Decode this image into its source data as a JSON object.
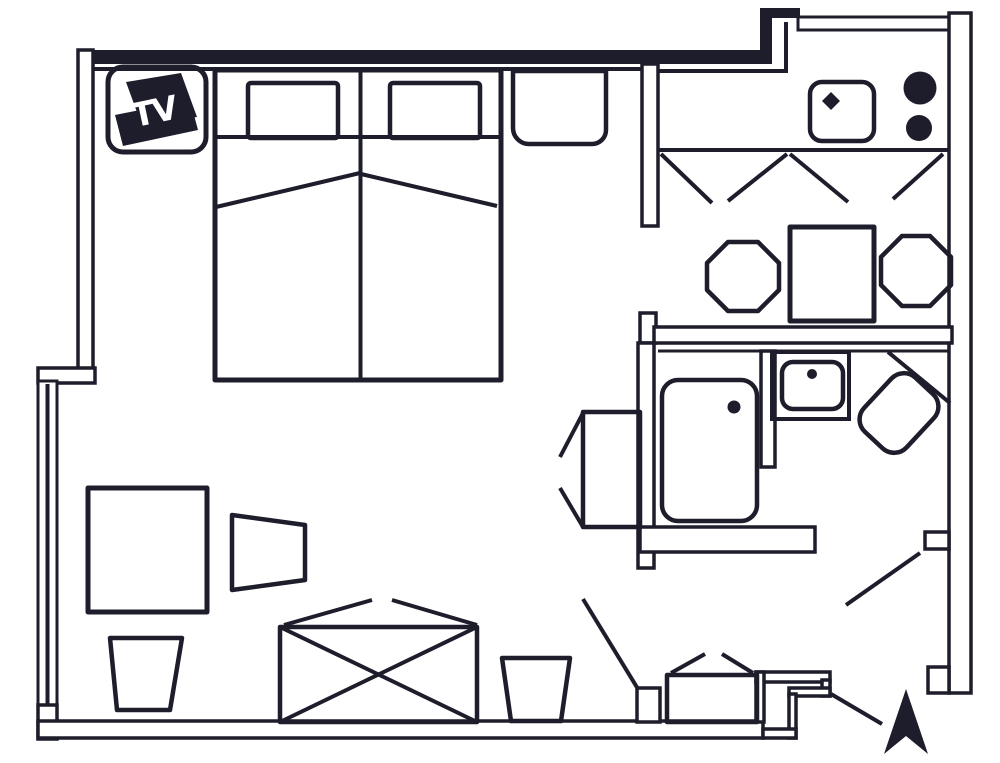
{
  "tv": {
    "label": "TV"
  },
  "colors": {
    "ink": "#1d1d2b",
    "background": "#ffffff"
  },
  "plan": {
    "type": "floor-plan",
    "rooms": [
      {
        "name": "bedroom-living-area",
        "symbols": [
          "double-bed",
          "pillow",
          "pillow",
          "tv-icon",
          "bedside-bench",
          "desk",
          "desk-chair",
          "wastebasket",
          "wastebasket",
          "luggage-rack",
          "wall-seat",
          "window"
        ]
      },
      {
        "name": "kitchenette-dining",
        "symbols": [
          "kitchen-sink",
          "hob-burner",
          "hob-burner",
          "counter-cabinets",
          "dining-table",
          "chair",
          "chair",
          "window"
        ]
      },
      {
        "name": "bathroom",
        "symbols": [
          "shower",
          "washbasin-vanity",
          "corner-toilet",
          "door-swing"
        ]
      },
      {
        "name": "entry-hall",
        "symbols": [
          "hall-bench",
          "door-swing",
          "entrance-door",
          "entrance-arrow"
        ]
      }
    ]
  }
}
